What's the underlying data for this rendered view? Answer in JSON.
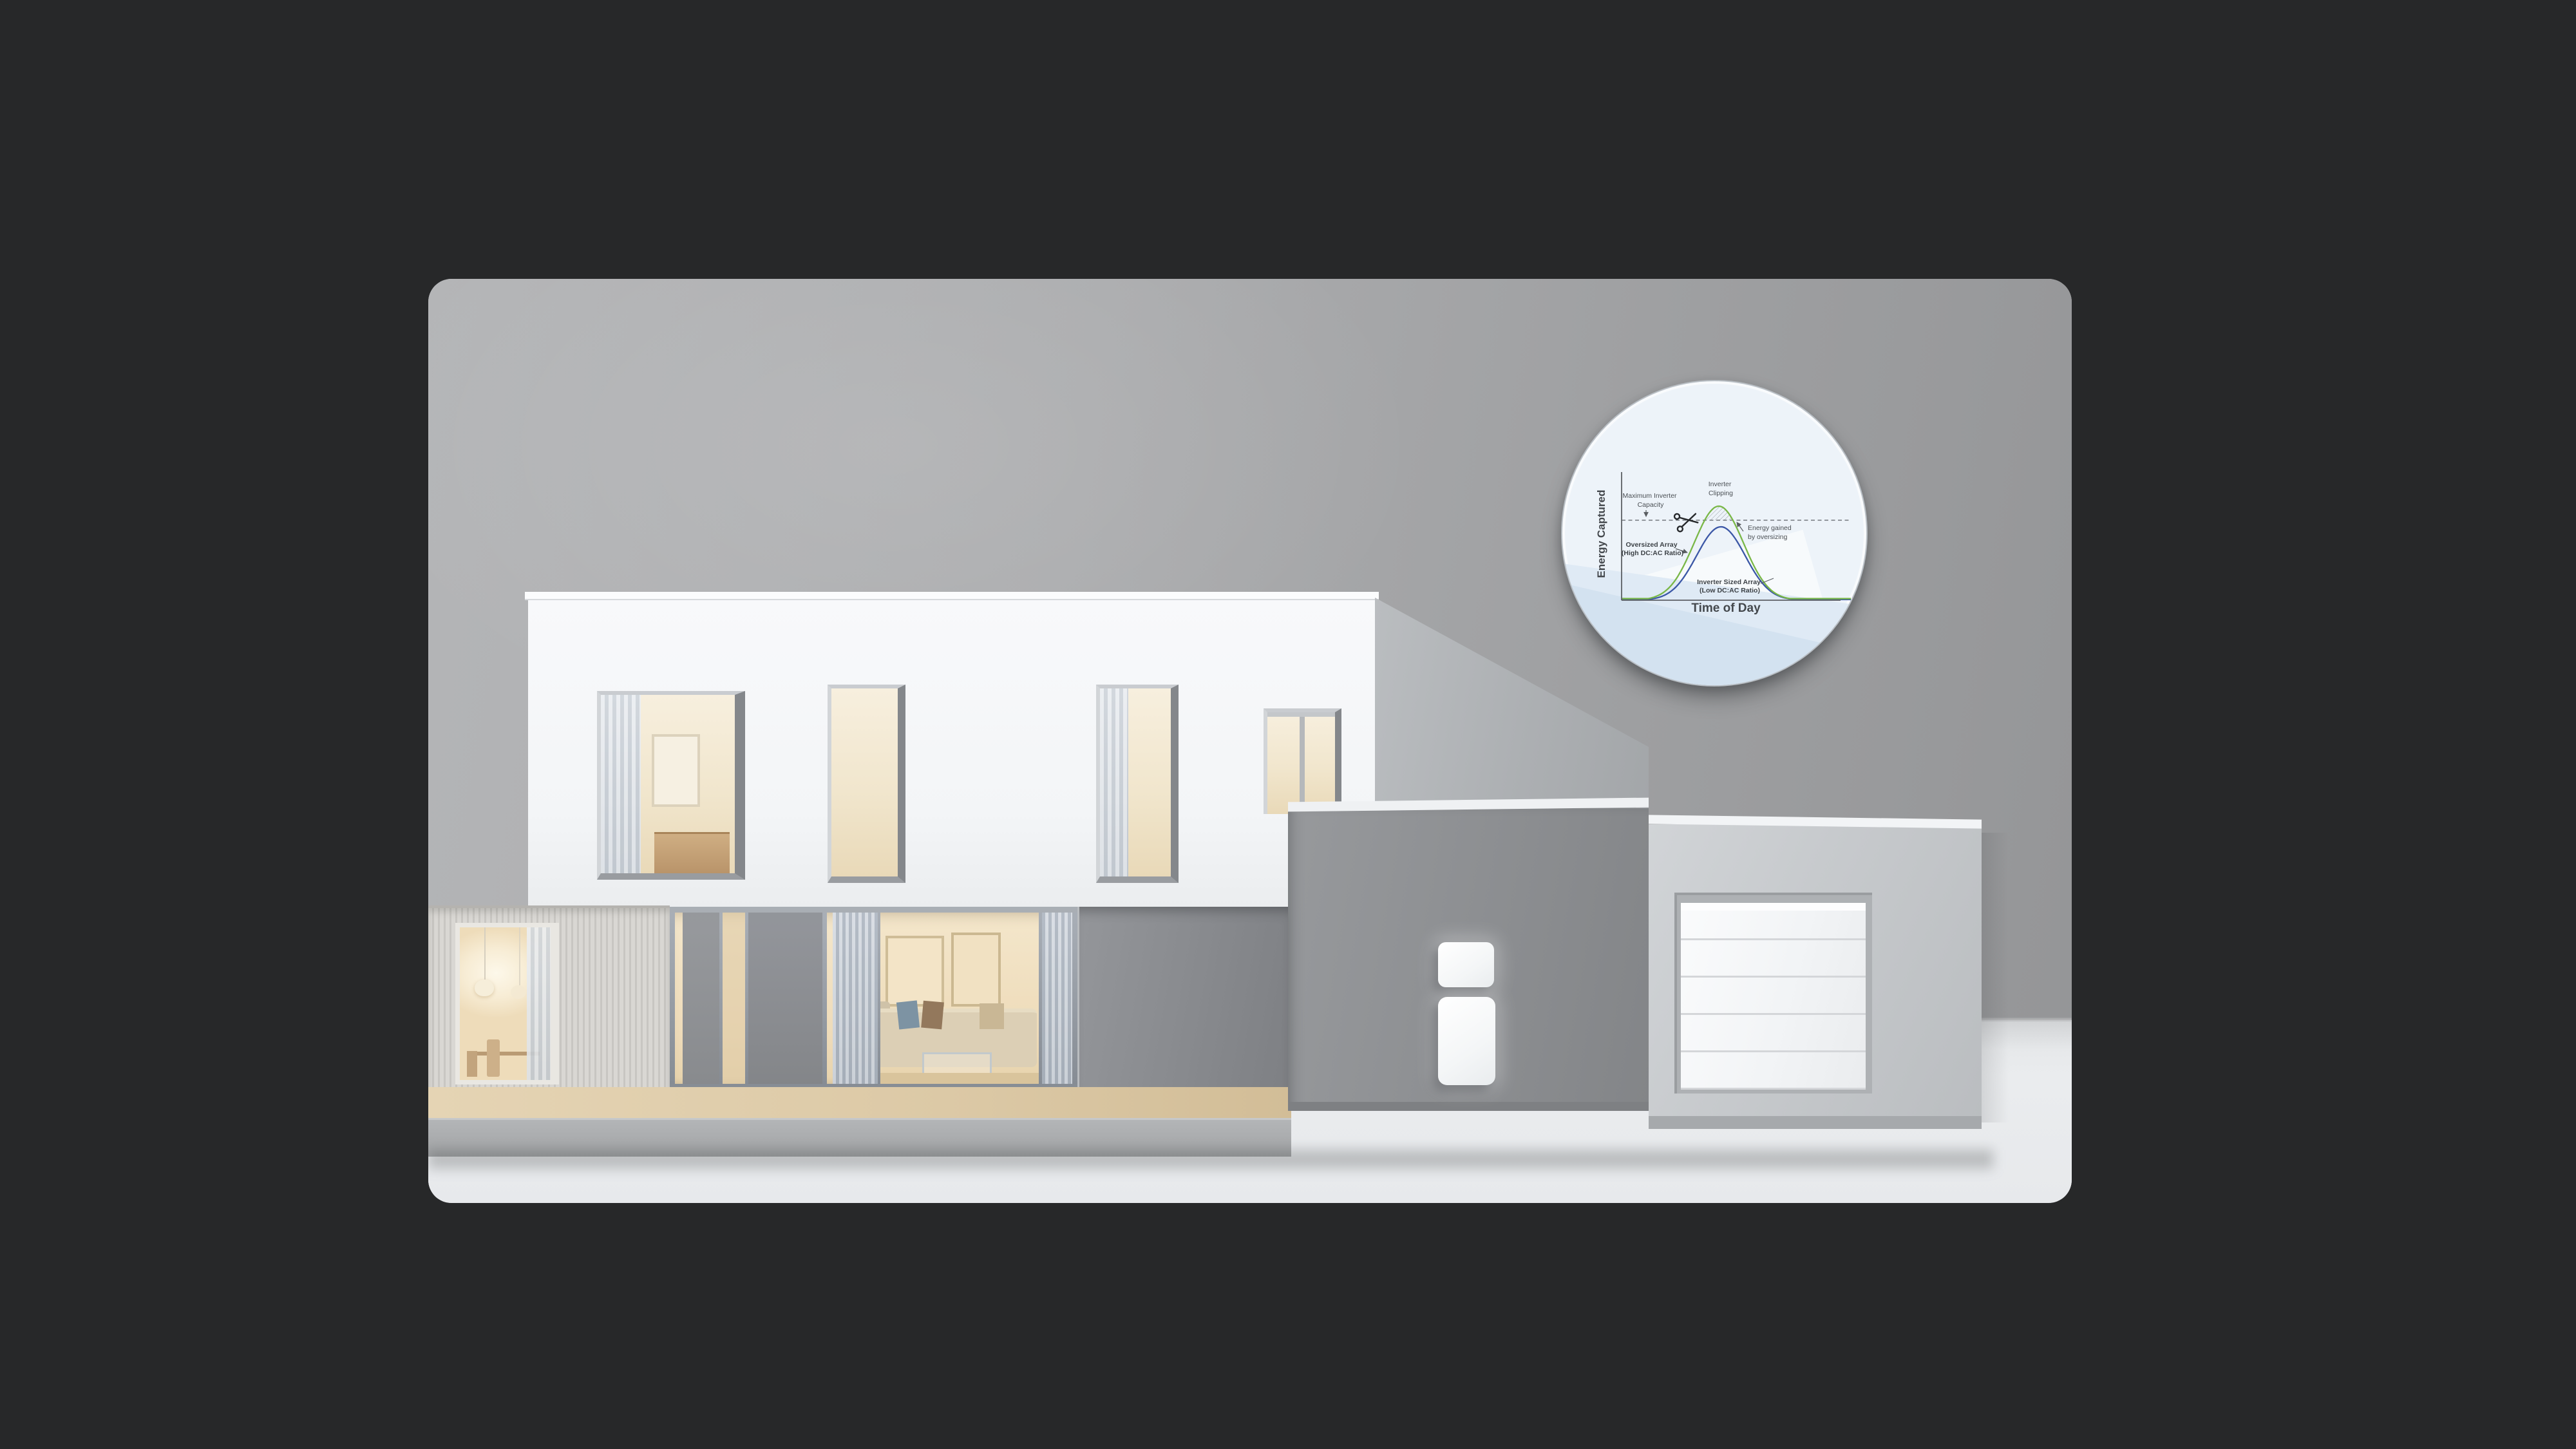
{
  "window": {
    "background_color": "#272829"
  },
  "scene": {
    "name": "modern-house-home-battery-render",
    "wall_color": "#a9abad",
    "floor_color": "#e9ebee",
    "house_white": "#f5f7f9",
    "garage_gray": "#8c8e91",
    "accent_green": "#79b747",
    "accent_blue": "#3b57a6"
  },
  "inset": {
    "ylabel": "Energy Captured",
    "xlabel": "Time of Day",
    "labels": {
      "max_capacity_line1": "Maximum Inverter",
      "max_capacity_line2": "Capacity",
      "clipping_line1": "Inverter",
      "clipping_line2": "Clipping",
      "gained_line1": "Energy gained",
      "gained_line2": "by oversizing",
      "oversized_line1": "Oversized Array",
      "oversized_line2": "(High DC:AC Ratio)",
      "sized_line1": "Inverter Sized Array",
      "sized_line2": "(Low DC:AC Ratio)"
    }
  },
  "chart_data": {
    "type": "line",
    "title": "Inverter Clipping",
    "xlabel": "Time of Day",
    "ylabel": "Energy Captured",
    "x_range": [
      0,
      1
    ],
    "grid": false,
    "legend_position": "inline-labels",
    "capacity_level": 1.09,
    "series": [
      {
        "name": "Oversized Array (High DC:AC Ratio)",
        "color": "#79b747",
        "shape": "gaussian",
        "center": 0.424,
        "sigma": 0.108,
        "peak": 1.281,
        "floor": 0.022
      },
      {
        "name": "Inverter Sized Array (Low DC:AC Ratio)",
        "color": "#3b57a6",
        "shape": "gaussian",
        "center": 0.433,
        "sigma": 0.106,
        "peak": 1.0,
        "floor": 0.01
      }
    ],
    "annotations": [
      "Maximum Inverter Capacity",
      "Inverter Clipping",
      "Energy gained by oversizing"
    ],
    "clipped_region": "hatched area between capacity line and oversized-array curve peak"
  }
}
